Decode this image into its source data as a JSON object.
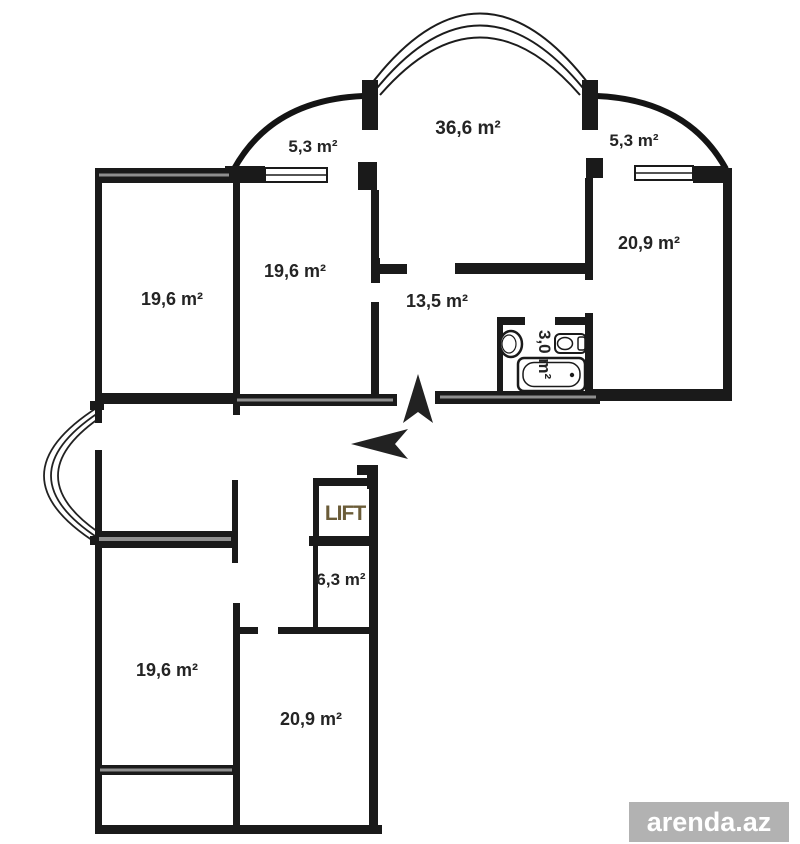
{
  "plan": {
    "rooms": [
      {
        "name": "balcony-top-left",
        "label": "5,3 m²"
      },
      {
        "name": "living-room",
        "label": "36,6 m²"
      },
      {
        "name": "balcony-top-right",
        "label": "5,3 m²"
      },
      {
        "name": "room-top-right",
        "label": "20,9 m²"
      },
      {
        "name": "room-upper-left",
        "label": "19,6 m²"
      },
      {
        "name": "room-upper-middle",
        "label": "19,6 m²"
      },
      {
        "name": "hall",
        "label": "13,5 m²"
      },
      {
        "name": "bathroom",
        "label": "3,0 m²"
      },
      {
        "name": "lift",
        "label": "LIFT"
      },
      {
        "name": "storage",
        "label": "6,3 m²"
      },
      {
        "name": "room-lower-left",
        "label": "19,6 m²"
      },
      {
        "name": "room-lower-right",
        "label": "20,9 m²"
      }
    ]
  },
  "watermark": {
    "text": "arenda.az"
  },
  "colors": {
    "wall": "#1a1a1a",
    "label_text": "#242424",
    "lift_text": "#6b5c38",
    "arrow": "#222222",
    "watermark_bg": "#b2b2b2",
    "watermark_text": "#ffffff"
  }
}
